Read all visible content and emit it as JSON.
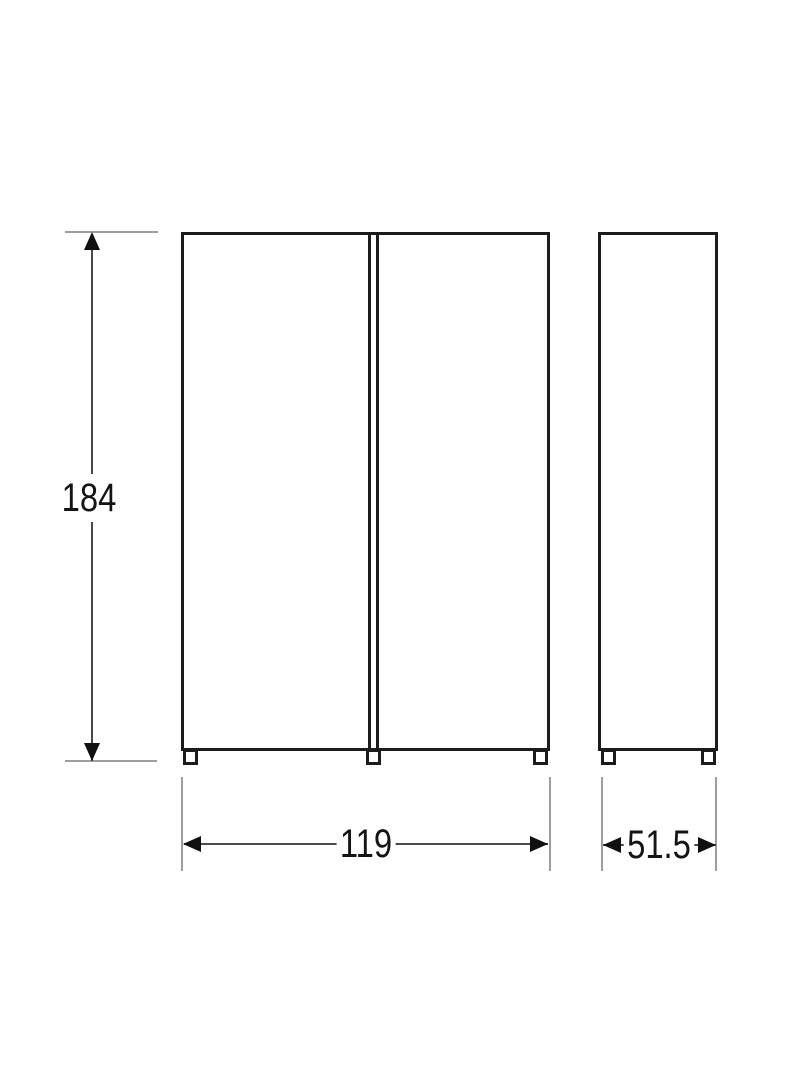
{
  "drawing": {
    "type": "furniture-dimension-drawing",
    "views": {
      "front": {
        "description": "two-door front elevation with three feet"
      },
      "side": {
        "description": "side elevation with two feet"
      }
    },
    "dimensions": {
      "height": {
        "value": "184"
      },
      "width": {
        "value": "119"
      },
      "depth": {
        "value": "51.5"
      }
    },
    "colors": {
      "outline": "#1c1c1c",
      "dimension_line": "#4a4a4a",
      "extension_line": "#9e9e9e",
      "text": "#141414",
      "background": "#ffffff"
    }
  }
}
